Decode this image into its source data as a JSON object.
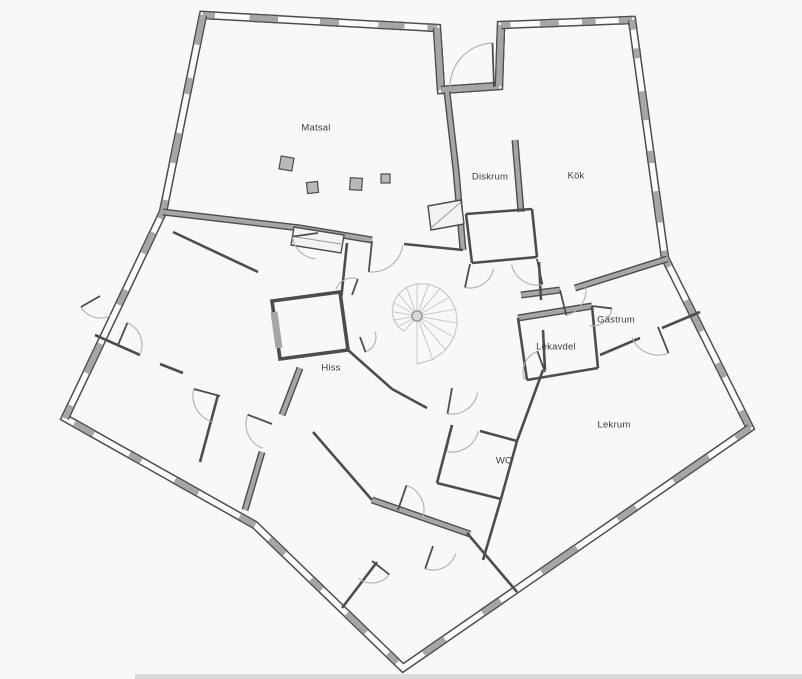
{
  "figure": {
    "type": "architectural-floor-plan",
    "building_shape": "pentagon",
    "features": [
      "spiral-staircase",
      "elevator-shaft",
      "door-swing-arcs",
      "window-pier-exterior-walls",
      "entrance-notch-top"
    ]
  },
  "rooms": [
    {
      "id": "matsal",
      "label": "Matsal",
      "x": 316,
      "y": 128
    },
    {
      "id": "diskrum",
      "label": "Diskrum",
      "x": 490,
      "y": 177
    },
    {
      "id": "kok",
      "label": "Kök",
      "x": 576,
      "y": 176
    },
    {
      "id": "gastrum",
      "label": "Gästrum",
      "x": 616,
      "y": 320
    },
    {
      "id": "lekavdel",
      "label": "Lekavdel",
      "x": 556,
      "y": 347
    },
    {
      "id": "lekrum",
      "label": "Lekrum",
      "x": 614,
      "y": 425
    },
    {
      "id": "wc",
      "label": "WC",
      "x": 504,
      "y": 461
    },
    {
      "id": "hiss",
      "label": "Hiss",
      "x": 331,
      "y": 368
    }
  ],
  "colors": {
    "background": "#f8f8f6",
    "wall_outline": "#4d4d4d",
    "wall_fill": "#a6a6a6",
    "window_core": "#fbfbfa",
    "door_arc": "#b0b0b0",
    "stair": "#c8c8c8",
    "label_text": "#3c3c3c",
    "bottom_strip": "#dadada"
  }
}
